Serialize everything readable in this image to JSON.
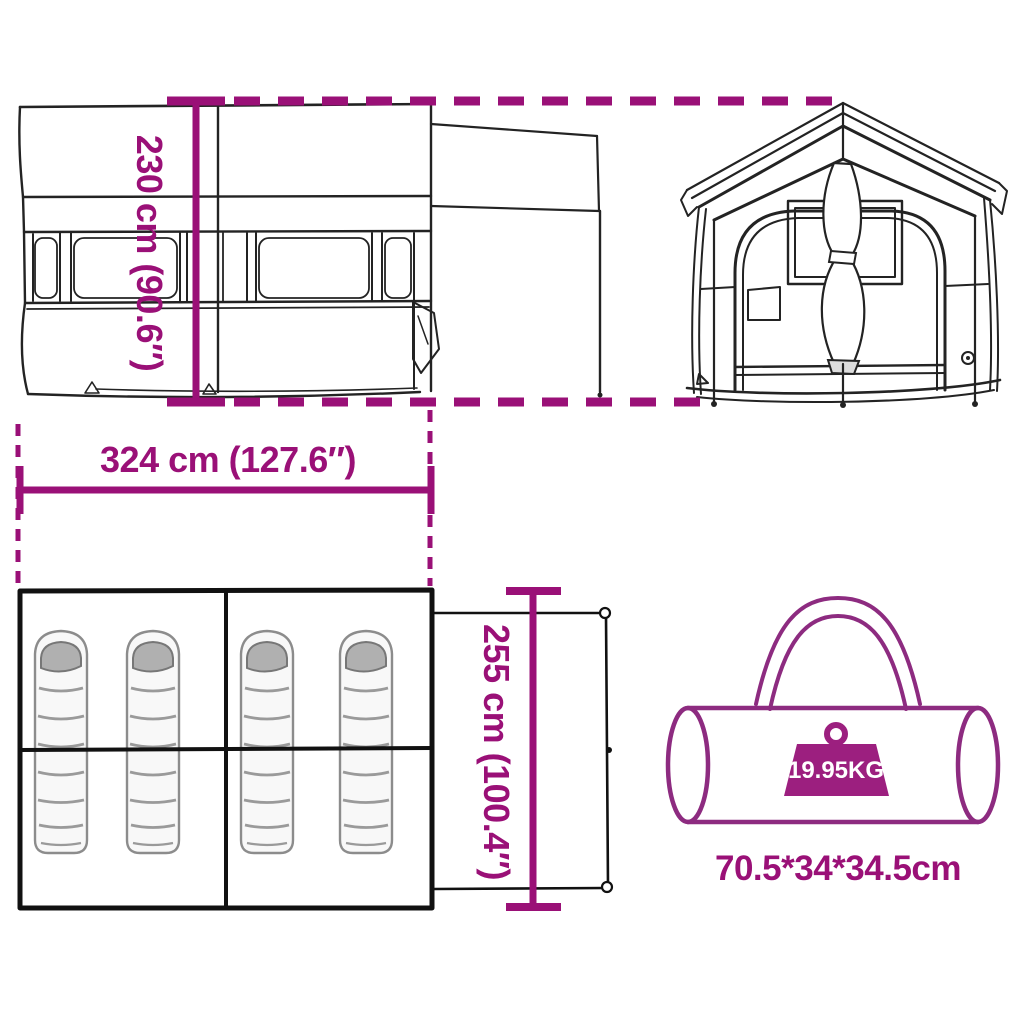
{
  "colors": {
    "accent": "#9a1077",
    "bag_outline": "#8d2b80",
    "weight_fill": "#9c1f7f",
    "sketch": "#232323",
    "plan": "#111111",
    "sleeping_bag_hood": "#b0b0b0",
    "sleeping_bag_body": "#f8f8f8"
  },
  "dimensions": {
    "height": "230 cm (90.6″)",
    "width": "324 cm (127.6″)",
    "depth": "255 cm (100.4″)"
  },
  "carry_bag": {
    "weight": "19.95KG",
    "size": "70.5*34*34.5cm"
  }
}
